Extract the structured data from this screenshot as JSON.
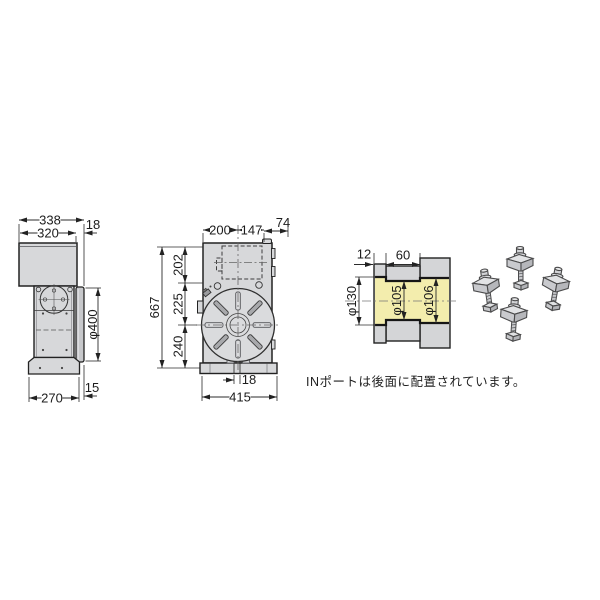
{
  "page": {
    "background": "#ffffff"
  },
  "note": {
    "text": "INポートは後面に配置されています。"
  },
  "colors": {
    "body_fill": "#d7d8da",
    "plate_fill": "#c7c8cb",
    "section_fill": "#d4d5d7",
    "bore_highlight": "#f3edad",
    "outline": "#222222"
  },
  "side_view": {
    "label": "side-view",
    "dims": {
      "overall_width": "338",
      "cover_width": "320",
      "table_offset": "18",
      "table_diameter": "φ400",
      "base_width": "270",
      "base_offset": "15"
    }
  },
  "front_view": {
    "label": "front-view",
    "dims": {
      "left_to_center": "200",
      "center_to_rear": "147",
      "rear_extension": "74",
      "overall_height": "667",
      "top_to_motor_center": "202",
      "motor_to_table_center": "225",
      "table_center_to_base": "240",
      "base_slot_width": "18",
      "overall_width": "415"
    }
  },
  "section_view": {
    "label": "spindle-bore-section",
    "dims": {
      "flange_depth": "12",
      "bore_length": "60",
      "front_bore_diameter": "φ130",
      "middle_bore_diameter": "φ105",
      "rear_bore_diameter": "φ106"
    }
  },
  "accessories": {
    "label": "clamp-set",
    "count": "4"
  }
}
